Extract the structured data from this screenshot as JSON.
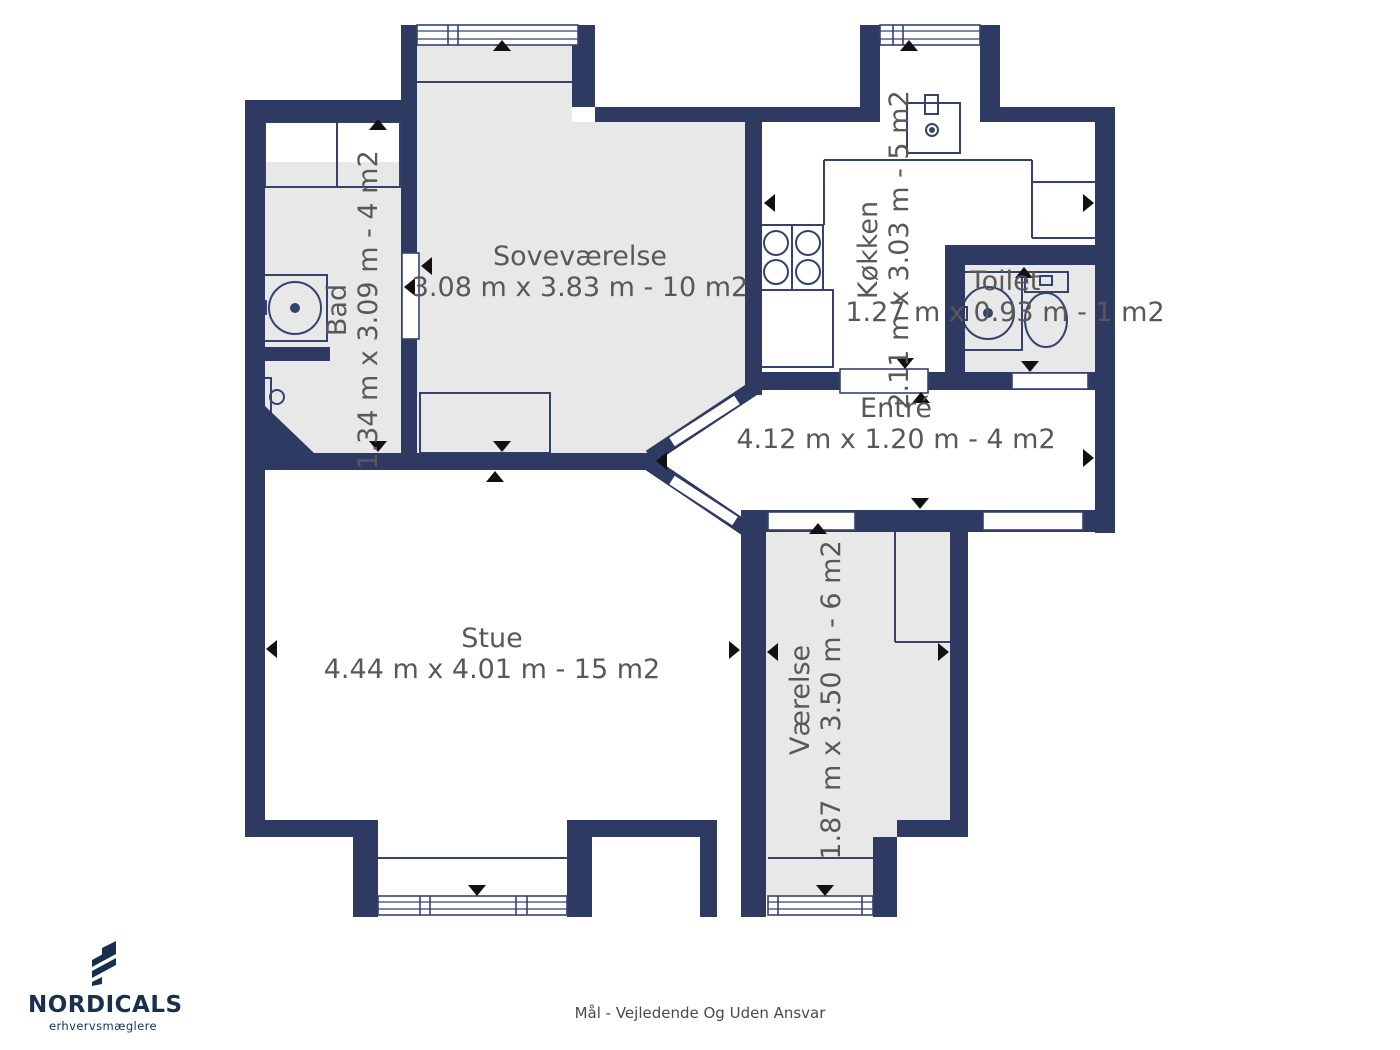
{
  "rooms": {
    "sovevaerelse": {
      "name": "Soveværelse",
      "dims": "3.08 m x 3.83 m - 10 m2"
    },
    "bad": {
      "name": "Bad",
      "dims": "1.34 m x 3.09 m - 4 m2"
    },
    "koekken": {
      "name": "Køkken",
      "dims": "2.11 m x 3.03 m - 5 m2"
    },
    "toilet": {
      "name": "Toilet",
      "dims": "1.27 m x 0.93 m - 1 m2"
    },
    "entre": {
      "name": "Entré",
      "dims": "4.12 m x 1.20 m - 4 m2"
    },
    "stue": {
      "name": "Stue",
      "dims": "4.44 m x 4.01 m - 15 m2"
    },
    "vaerelse": {
      "name": "Værelse",
      "dims": "1.87 m x 3.50 m - 6 m2"
    }
  },
  "branding": {
    "name": "NORDICALS",
    "tagline": "erhvervsmæglere"
  },
  "footer": {
    "disclaimer": "Mål - Vejledende Og Uden Ansvar"
  },
  "colors": {
    "wall": "#2e3a62",
    "floor": "#e8e8e8",
    "line": "#35426e",
    "label_text": "#585858",
    "arrow": "#111111",
    "logo": "#18304d"
  }
}
